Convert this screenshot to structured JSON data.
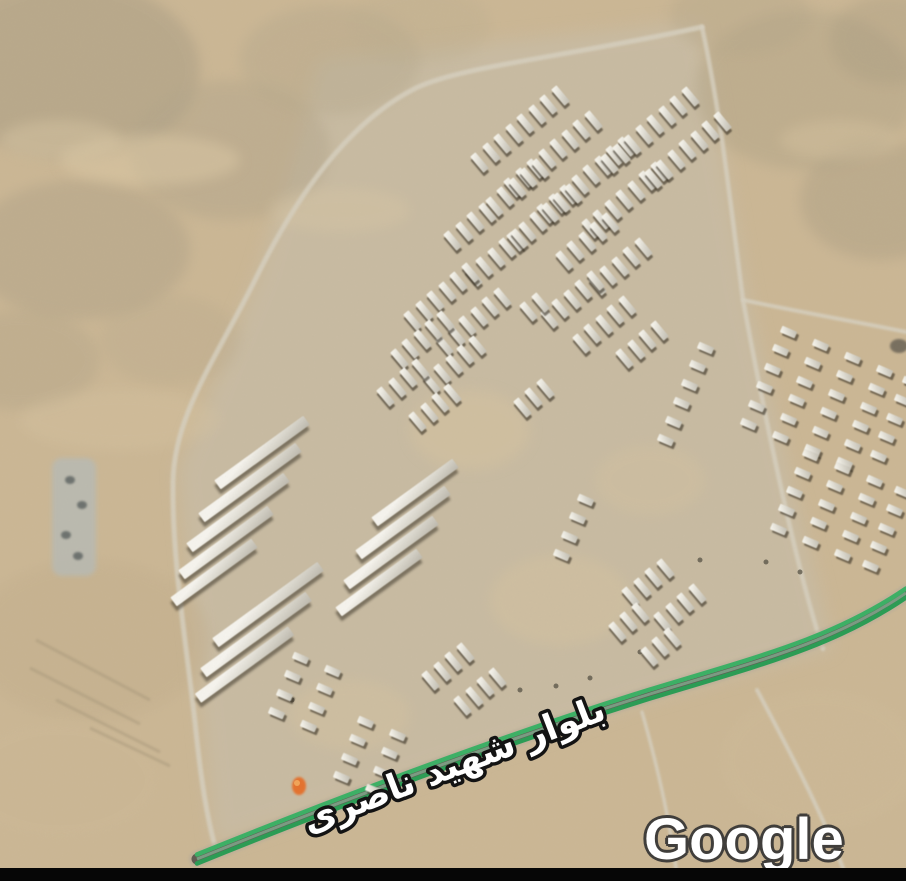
{
  "labels": {
    "boulevard": "بلوار شهید ناصری",
    "watermark": "Google"
  },
  "colors": {
    "terrain_base": "#cbb795",
    "road": "#d6cfbe",
    "traffic_green_bright": "#3bb065",
    "traffic_green_dark": "#2a9c54",
    "traffic_mid": "#7da287",
    "road_dark": "#5f5b52",
    "road_bed": "#b7ac99",
    "label_fill": "#ffffff",
    "label_outline": "#131313",
    "watermark_outline": "#403e3b",
    "marker": "#e4722e",
    "bottom_bar": "#060606"
  },
  "terrain": {
    "graded_area": {
      "d": "M 320,60 L 700,22 L 748,300 L 832,648 L 645,700 L 215,845 L 178,470 L 260,270 Z",
      "fill": "#c6c0b0",
      "opacity": 0.5
    },
    "patches": [
      {
        "x": 70,
        "y": 70,
        "rx": 130,
        "ry": 90,
        "c": "#a99c83",
        "o": 0.5
      },
      {
        "x": 230,
        "y": 150,
        "rx": 100,
        "ry": 70,
        "c": "#b2a58a",
        "o": 0.45
      },
      {
        "x": 80,
        "y": 250,
        "rx": 110,
        "ry": 70,
        "c": "#ac9f85",
        "o": 0.4
      },
      {
        "x": 330,
        "y": 60,
        "rx": 90,
        "ry": 55,
        "c": "#b5a88c",
        "o": 0.4
      },
      {
        "x": 20,
        "y": 360,
        "rx": 80,
        "ry": 50,
        "c": "#b0a286",
        "o": 0.35
      },
      {
        "x": 170,
        "y": 340,
        "rx": 70,
        "ry": 45,
        "c": "#b8a98c",
        "o": 0.3
      },
      {
        "x": 420,
        "y": 25,
        "rx": 70,
        "ry": 40,
        "c": "#bcae90",
        "o": 0.3
      },
      {
        "x": 805,
        "y": 90,
        "rx": 110,
        "ry": 80,
        "c": "#b1a487",
        "o": 0.45
      },
      {
        "x": 880,
        "y": 200,
        "rx": 80,
        "ry": 60,
        "c": "#aa9d82",
        "o": 0.4
      },
      {
        "x": 740,
        "y": 15,
        "rx": 70,
        "ry": 40,
        "c": "#b4a689",
        "o": 0.35
      },
      {
        "x": 890,
        "y": 40,
        "rx": 60,
        "ry": 45,
        "c": "#a89b80",
        "o": 0.35
      },
      {
        "x": 150,
        "y": 160,
        "rx": 90,
        "ry": 25,
        "c": "#dcc9a6",
        "o": 0.5
      },
      {
        "x": 60,
        "y": 140,
        "rx": 60,
        "ry": 20,
        "c": "#d9c7a5",
        "o": 0.45
      },
      {
        "x": 340,
        "y": 210,
        "rx": 70,
        "ry": 22,
        "c": "#d8c6a4",
        "o": 0.4
      },
      {
        "x": 840,
        "y": 140,
        "rx": 60,
        "ry": 20,
        "c": "#d8c5a2",
        "o": 0.4
      },
      {
        "x": 120,
        "y": 420,
        "rx": 100,
        "ry": 30,
        "c": "#d5c2a0",
        "o": 0.4
      },
      {
        "x": 90,
        "y": 640,
        "rx": 120,
        "ry": 80,
        "c": "#c2ae8c",
        "o": 0.4
      },
      {
        "x": 60,
        "y": 780,
        "rx": 100,
        "ry": 60,
        "c": "#cdb997",
        "o": 0.4
      },
      {
        "x": 820,
        "y": 760,
        "rx": 100,
        "ry": 70,
        "c": "#cfbb99",
        "o": 0.4
      },
      {
        "x": 470,
        "y": 430,
        "rx": 60,
        "ry": 40,
        "c": "#d6c3a0",
        "o": 0.5
      },
      {
        "x": 560,
        "y": 600,
        "rx": 70,
        "ry": 45,
        "c": "#d6c3a0",
        "o": 0.45
      },
      {
        "x": 350,
        "y": 715,
        "rx": 60,
        "ry": 35,
        "c": "#d6c3a0",
        "o": 0.4
      },
      {
        "x": 650,
        "y": 480,
        "rx": 55,
        "ry": 35,
        "c": "#d6c3a0",
        "o": 0.35
      }
    ],
    "furrows": [
      [
        36,
        640,
        150,
        700
      ],
      [
        30,
        668,
        140,
        724
      ],
      [
        56,
        700,
        160,
        752
      ],
      [
        90,
        728,
        170,
        766
      ]
    ],
    "dots": [
      [
        292,
        700
      ],
      [
        520,
        690
      ],
      [
        556,
        686
      ],
      [
        590,
        678
      ],
      [
        766,
        562
      ],
      [
        800,
        572
      ],
      [
        640,
        652
      ],
      [
        700,
        560
      ]
    ],
    "rock_blob": {
      "x": 899,
      "y": 346,
      "rx": 9,
      "ry": 7,
      "c": "#6b6457",
      "o": 0.85
    }
  },
  "roads": [
    {
      "name": "west-ring-road",
      "d": "M 702,27 C 560,58 462,66 416,88 C 348,122 296,196 254,282 C 214,362 174,416 173,482 C 172,560 186,642 195,722 C 200,772 207,818 215,846",
      "w": 5
    },
    {
      "name": "east-road",
      "d": "M 702,27 C 722,120 731,210 743,300 C 760,392 794,562 823,649",
      "w": 4.5
    },
    {
      "name": "north-east-spur",
      "d": "M 743,300 C 800,312 868,324 906,332",
      "w": 4
    },
    {
      "name": "southeast-track",
      "d": "M 757,690 C 790,752 822,812 848,881",
      "w": 4
    },
    {
      "name": "south-track",
      "d": "M 642,712 C 658,768 670,824 676,868",
      "w": 3.5
    }
  ],
  "boulevard": {
    "name": "بلوار شهید ناصری",
    "d": "M 197,859 C 340,801 500,741 650,694 C 762,660 834,642 906,593"
  },
  "buildings": {
    "teeth": {
      "angle": 140,
      "spacing": 15,
      "w": 7,
      "h": 21,
      "rows": [
        [
          560,
          95,
          8
        ],
        [
          593,
          120,
          8
        ],
        [
          626,
          146,
          8
        ],
        [
          659,
          171,
          7
        ],
        [
          540,
          168,
          5
        ],
        [
          573,
          193,
          6
        ],
        [
          690,
          96,
          8
        ],
        [
          722,
          121,
          7
        ],
        [
          487,
          212,
          4
        ],
        [
          519,
          238,
          5
        ],
        [
          610,
          222,
          5
        ],
        [
          643,
          247,
          5
        ],
        [
          470,
          272,
          6
        ],
        [
          502,
          297,
          6
        ],
        [
          445,
          320,
          5
        ],
        [
          477,
          345,
          5
        ],
        [
          420,
          368,
          4
        ],
        [
          452,
          393,
          4
        ],
        [
          595,
          280,
          5
        ],
        [
          627,
          305,
          5
        ],
        [
          659,
          330,
          4
        ],
        [
          540,
          302,
          2
        ],
        [
          545,
          388,
          3
        ],
        [
          665,
          568,
          4
        ],
        [
          697,
          593,
          4
        ],
        [
          640,
          612,
          3
        ],
        [
          672,
          637,
          3
        ],
        [
          465,
          652,
          4
        ],
        [
          497,
          677,
          4
        ]
      ]
    },
    "teeth_steep": {
      "angle": 113,
      "spacing": 20,
      "w": 7,
      "h": 16,
      "rows": [
        [
          788,
          332,
          6
        ],
        [
          820,
          345,
          6
        ],
        [
          852,
          358,
          6
        ],
        [
          884,
          371,
          6
        ],
        [
          910,
          382,
          5
        ],
        [
          810,
          455,
          5
        ],
        [
          842,
          468,
          5
        ],
        [
          874,
          481,
          5
        ],
        [
          902,
          492,
          5
        ],
        [
          705,
          348,
          6
        ],
        [
          585,
          500,
          4
        ],
        [
          300,
          658,
          4
        ],
        [
          332,
          671,
          4
        ],
        [
          365,
          722,
          4
        ],
        [
          397,
          735,
          4
        ]
      ]
    },
    "bars": {
      "angle": -36,
      "thickness": 11,
      "items": [
        [
          262,
          452,
          110
        ],
        [
          250,
          482,
          120
        ],
        [
          238,
          512,
          120
        ],
        [
          226,
          542,
          110
        ],
        [
          214,
          572,
          100
        ],
        [
          415,
          492,
          100
        ],
        [
          403,
          522,
          110
        ],
        [
          391,
          552,
          110
        ],
        [
          379,
          582,
          100
        ],
        [
          268,
          604,
          130
        ],
        [
          256,
          634,
          130
        ],
        [
          244,
          664,
          115
        ]
      ]
    }
  },
  "compound": {
    "x": 52,
    "y": 458,
    "w": 44,
    "h": 118,
    "c": "#b6bbb8",
    "o": 0.75,
    "dots": [
      [
        70,
        480
      ],
      [
        82,
        505
      ],
      [
        66,
        535
      ],
      [
        78,
        556
      ]
    ]
  },
  "marker": {
    "x": 299,
    "y": 786,
    "color": "#e4722e"
  }
}
